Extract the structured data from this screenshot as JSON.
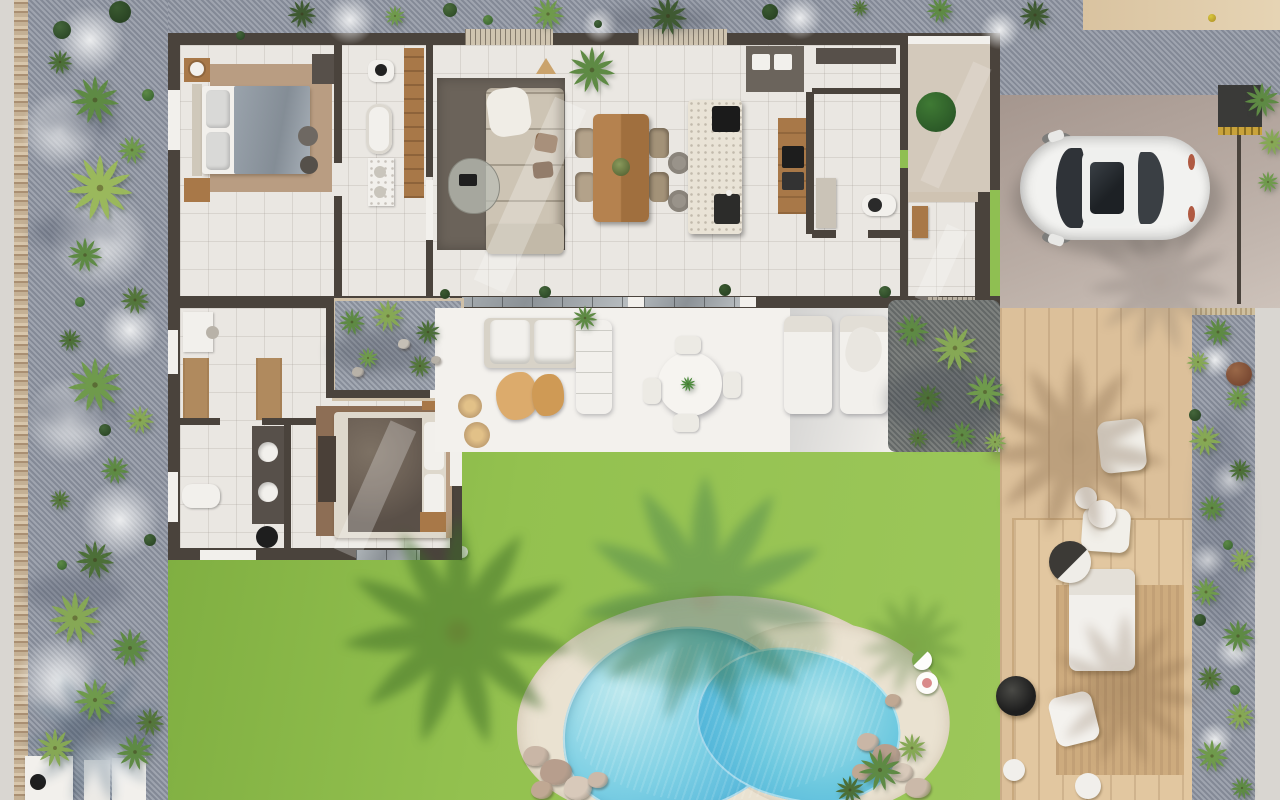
{
  "labels": {
    "scene": "Villa floor plan - aerial 3D render",
    "bedroom_main": "Main bedroom",
    "ensuite": "En-suite bathroom",
    "living": "Living room",
    "dining": "Dining area",
    "kitchen": "Kitchen",
    "laundry": "Laundry / utility",
    "bathroom": "Guest bathroom",
    "entry": "Entry courtyard",
    "hall": "Entry hall",
    "courtyard": "Planted patio",
    "corridor": "Dressing corridor",
    "bedroom2": "Second bedroom",
    "bathroom2": "Family bathroom",
    "terrace": "Covered terrace",
    "lounge": "Outdoor lounge",
    "outdoor_dining": "Outdoor dining",
    "loungers": "Sun loungers",
    "lawn": "Lawn",
    "pool": "Swimming pool",
    "pool_deck": "Pool deck",
    "deck": "Wooden deck",
    "fire": "Fire bowl",
    "daybed": "Daybed",
    "car": "Car",
    "driveway": "Driveway",
    "garden_left": "Gravel garden",
    "garden_right": "Gravel planting bed",
    "path": "Perimeter path"
  },
  "palette": {
    "lawn": "#93c14f",
    "lawnShade": "#7fae41",
    "pool": "#4fb3d9",
    "poolLight": "#bfe9ee",
    "poolDeck": "#eae2d1",
    "gravel": "#949aa6",
    "pebble": "#c4b094",
    "path": "#d9d6d1",
    "wallDark": "#4a433c",
    "floor": "#eae7e2",
    "court": "#d3c9bb",
    "driveway": "#ab9c94",
    "deckWood": "#dcc09a",
    "deckSlat": "#cdab7e",
    "woodCabinet": "#a87848",
    "woodTable": "#b5824f",
    "island": "#e9e3d6",
    "rugLiving": "#6b635a",
    "rugBed1": "#b99d82",
    "rugBed2": "#8d6e55",
    "sofa": "#cdc4b4",
    "bedGray": "#9aa3ac",
    "bedDark": "#6e6257",
    "carBody": "#f2f2f0",
    "glassDark": "#2f3338",
    "tanWall": "#d9c3a0",
    "gold": "#c9a33b",
    "fire": "#1e1e1e",
    "potBrown": "#7a4a33"
  },
  "vegetation": {
    "palms": [
      [
        95,
        100,
        50,
        "#5e8a44"
      ],
      [
        60,
        62,
        26,
        "#4c6f38"
      ],
      [
        132,
        150,
        30,
        "#6f9a4c"
      ],
      [
        100,
        188,
        68,
        "#9ab85c"
      ],
      [
        85,
        255,
        36,
        "#5e8a44"
      ],
      [
        135,
        300,
        30,
        "#54763c"
      ],
      [
        70,
        340,
        24,
        "#4c6f38"
      ],
      [
        95,
        385,
        56,
        "#6f9a4c"
      ],
      [
        140,
        420,
        30,
        "#86a855"
      ],
      [
        115,
        470,
        30,
        "#5e8a44"
      ],
      [
        60,
        500,
        22,
        "#54763c"
      ],
      [
        95,
        560,
        40,
        "#4c6f38"
      ],
      [
        75,
        618,
        54,
        "#86a855"
      ],
      [
        130,
        648,
        40,
        "#5e8a44"
      ],
      [
        95,
        700,
        44,
        "#6f9a4c"
      ],
      [
        150,
        722,
        30,
        "#54763c"
      ],
      [
        55,
        748,
        40,
        "#86a855"
      ],
      [
        135,
        752,
        38,
        "#5e8a44"
      ],
      [
        302,
        14,
        30,
        "#3f5a32"
      ],
      [
        395,
        16,
        22,
        "#6f9a4c"
      ],
      [
        548,
        14,
        34,
        "#6f9a4c"
      ],
      [
        668,
        16,
        40,
        "#3f5a32"
      ],
      [
        860,
        8,
        18,
        "#54763c"
      ],
      [
        940,
        10,
        28,
        "#5e8a44"
      ],
      [
        1035,
        15,
        32,
        "#3f5a32"
      ],
      [
        352,
        322,
        28,
        "#5e8a44"
      ],
      [
        388,
        316,
        34,
        "#86a855"
      ],
      [
        428,
        332,
        26,
        "#4c6f38"
      ],
      [
        368,
        358,
        22,
        "#6f9a4c"
      ],
      [
        420,
        366,
        24,
        "#54763c"
      ],
      [
        912,
        330,
        36,
        "#5e8a44"
      ],
      [
        955,
        348,
        48,
        "#86a855"
      ],
      [
        985,
        392,
        40,
        "#6f9a4c"
      ],
      [
        928,
        398,
        30,
        "#4c6f38"
      ],
      [
        962,
        435,
        30,
        "#5e8a44"
      ],
      [
        995,
        442,
        24,
        "#86a855"
      ],
      [
        918,
        438,
        22,
        "#54763c"
      ],
      [
        585,
        318,
        26,
        "#5e8a44"
      ],
      [
        592,
        70,
        48,
        "#5e8a44"
      ],
      [
        688,
        384,
        16,
        "#4c8a3c"
      ],
      [
        1218,
        332,
        30,
        "#5e8a44"
      ],
      [
        1198,
        362,
        24,
        "#86a855"
      ],
      [
        1238,
        398,
        26,
        "#6f9a4c"
      ],
      [
        1205,
        440,
        34,
        "#86a855"
      ],
      [
        1240,
        470,
        24,
        "#4c6f38"
      ],
      [
        1212,
        508,
        28,
        "#5e8a44"
      ],
      [
        1242,
        560,
        26,
        "#86a855"
      ],
      [
        1206,
        592,
        30,
        "#6f9a4c"
      ],
      [
        1238,
        636,
        34,
        "#5e8a44"
      ],
      [
        1210,
        678,
        26,
        "#54763c"
      ],
      [
        1240,
        716,
        30,
        "#86a855"
      ],
      [
        1212,
        756,
        34,
        "#6f9a4c"
      ],
      [
        1242,
        788,
        24,
        "#5e8a44"
      ],
      [
        1262,
        100,
        36,
        "#5e8a44"
      ],
      [
        1272,
        142,
        28,
        "#86a855"
      ],
      [
        1268,
        182,
        22,
        "#6f9a4c"
      ],
      [
        880,
        770,
        44,
        "#5e8a44"
      ],
      [
        912,
        748,
        30,
        "#86a855"
      ],
      [
        850,
        790,
        30,
        "#4c6f38"
      ]
    ],
    "bushes": [
      [
        120,
        12,
        22,
        "#3a5a30",
        "#2a4424"
      ],
      [
        62,
        30,
        18,
        "#44663a",
        "#2e4a28"
      ],
      [
        450,
        10,
        14,
        "#4a6c3c",
        "#32502a"
      ],
      [
        770,
        12,
        16,
        "#3a5a30",
        "#2a4424"
      ],
      [
        936,
        112,
        40,
        "#3f7a34",
        "#2c5a28"
      ],
      [
        148,
        95,
        12,
        "#5d8a46",
        "#3f6a34"
      ],
      [
        80,
        302,
        10,
        "#5d8a46",
        "#3f6a34"
      ],
      [
        105,
        430,
        12,
        "#44663a",
        "#2e4a28"
      ],
      [
        62,
        565,
        10,
        "#5d8a46",
        "#3f6a34"
      ],
      [
        150,
        540,
        12,
        "#44663a",
        "#2e4a28"
      ],
      [
        488,
        20,
        10,
        "#5d8a46",
        "#3f6a34"
      ],
      [
        598,
        24,
        8,
        "#44663a",
        "#2e4a28"
      ],
      [
        1195,
        415,
        12,
        "#44663a",
        "#2e4a28"
      ],
      [
        1228,
        545,
        10,
        "#5d8a46",
        "#3f6a34"
      ],
      [
        1200,
        620,
        12,
        "#44663a",
        "#2e4a28"
      ],
      [
        1235,
        690,
        10,
        "#5d8a46",
        "#3f6a34"
      ],
      [
        445,
        294,
        10,
        "#3a5a30",
        "#2a4424"
      ],
      [
        545,
        292,
        12,
        "#44663a",
        "#2e4a28"
      ],
      [
        725,
        290,
        12,
        "#3a5a30",
        "#2a4424"
      ],
      [
        885,
        292,
        12,
        "#44663a",
        "#2e4a28"
      ],
      [
        240,
        35,
        9,
        "#44663a",
        "#2e4a28"
      ],
      [
        1212,
        18,
        8,
        "#d8c83c",
        "#b89c2c"
      ]
    ],
    "rocks": [
      [
        536,
        756,
        16,
        "#c9b6a6"
      ],
      [
        556,
        772,
        20,
        "#b79e8d"
      ],
      [
        578,
        788,
        18,
        "#d8c9ba"
      ],
      [
        542,
        790,
        14,
        "#c0a893"
      ],
      [
        598,
        780,
        12,
        "#cbb9a9"
      ],
      [
        868,
        742,
        14,
        "#c9b6a6"
      ],
      [
        886,
        756,
        18,
        "#b79e8d"
      ],
      [
        902,
        772,
        14,
        "#d8c9ba"
      ],
      [
        862,
        772,
        12,
        "#c0a893"
      ],
      [
        918,
        788,
        16,
        "#cbb9a9"
      ],
      [
        893,
        700,
        10,
        "#c0a893"
      ],
      [
        358,
        372,
        8,
        "#b8b2a8"
      ],
      [
        404,
        344,
        7,
        "#c5bfb5"
      ],
      [
        436,
        360,
        6,
        "#b8b2a8"
      ]
    ],
    "patches": [
      [
        60,
        130,
        40
      ],
      [
        100,
        240,
        50
      ],
      [
        70,
        420,
        45
      ],
      [
        120,
        520,
        40
      ],
      [
        60,
        680,
        45
      ],
      [
        110,
        760,
        40
      ],
      [
        90,
        40,
        35
      ],
      [
        130,
        330,
        30
      ],
      [
        350,
        20,
        25
      ],
      [
        800,
        18,
        22
      ],
      [
        600,
        25,
        18
      ],
      [
        1000,
        30,
        20
      ],
      [
        1215,
        360,
        18
      ],
      [
        1230,
        480,
        20
      ],
      [
        1208,
        560,
        18
      ],
      [
        1235,
        650,
        20
      ],
      [
        1215,
        740,
        18
      ]
    ],
    "shadows": [
      {
        "t": "b",
        "x": 458,
        "y": 632,
        "s": 240,
        "c": "#3c6b26",
        "o": 0.5
      },
      {
        "t": "b",
        "x": 705,
        "y": 600,
        "s": 260,
        "c": "#2f6b4a",
        "o": 0.32
      },
      {
        "t": "b",
        "x": 1075,
        "y": 448,
        "s": 190,
        "c": "#6b4f33",
        "o": 0.28
      },
      {
        "t": "b",
        "x": 1125,
        "y": 690,
        "s": 160,
        "c": "#6b4f33",
        "o": 0.22
      },
      {
        "t": "b",
        "x": 1160,
        "y": 282,
        "s": 150,
        "c": "#5a5350",
        "o": 0.18
      },
      {
        "t": "b",
        "x": 912,
        "y": 645,
        "s": 110,
        "c": "#3c6b26",
        "o": 0.3
      },
      {
        "t": "b",
        "x": 95,
        "y": 735,
        "s": 150,
        "c": "#2f4f66",
        "o": 0.25
      },
      {
        "t": "e",
        "x": 80,
        "y": 122,
        "w": 80,
        "h": 30,
        "c": "#4e5668",
        "o": 0.35
      },
      {
        "t": "e",
        "x": 75,
        "y": 232,
        "w": 90,
        "h": 34,
        "c": "#4e5668",
        "o": 0.35
      },
      {
        "t": "e",
        "x": 78,
        "y": 412,
        "w": 90,
        "h": 34,
        "c": "#4e5668",
        "o": 0.35
      },
      {
        "t": "e",
        "x": 75,
        "y": 592,
        "w": 100,
        "h": 38,
        "c": "#4e5668",
        "o": 0.32
      },
      {
        "t": "e",
        "x": 105,
        "y": 732,
        "w": 100,
        "h": 36,
        "c": "#4e5668",
        "o": 0.3
      },
      {
        "t": "e",
        "x": 380,
        "y": 352,
        "w": 100,
        "h": 44,
        "c": "#3e4450",
        "o": 0.3
      },
      {
        "t": "e",
        "x": 945,
        "y": 400,
        "w": 120,
        "h": 70,
        "c": "#3e4450",
        "o": 0.3
      },
      {
        "t": "e",
        "x": 1222,
        "y": 520,
        "w": 54,
        "h": 220,
        "c": "#4e5668",
        "o": 0.22
      },
      {
        "t": "e",
        "x": 1118,
        "y": 200,
        "w": 210,
        "h": 112,
        "c": "#55504b",
        "o": 0.32
      },
      {
        "t": "e",
        "x": 658,
        "y": 20,
        "w": 120,
        "h": 26,
        "c": "#3e4450",
        "o": 0.25
      },
      {
        "t": "e",
        "x": 700,
        "y": 640,
        "w": 260,
        "h": 90,
        "c": "#3c6b26",
        "o": 0.2
      }
    ]
  }
}
